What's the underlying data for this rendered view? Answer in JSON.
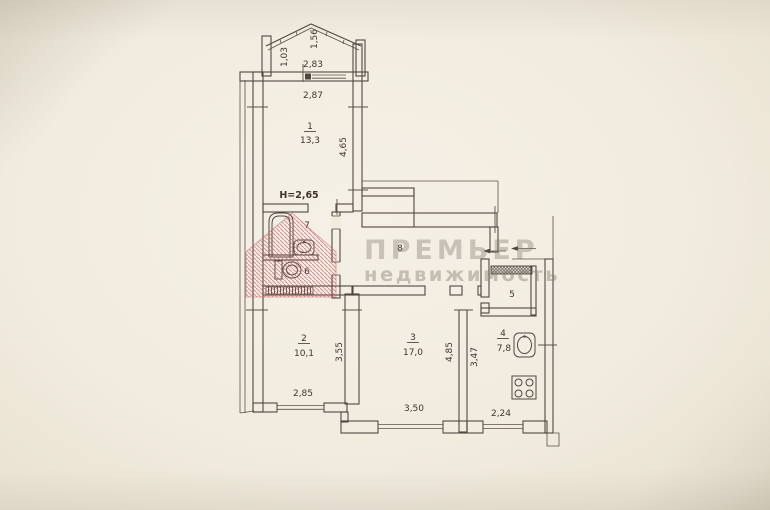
{
  "plan": {
    "height_note": "H=2,65",
    "rooms": [
      {
        "number": "1",
        "area": "13,3"
      },
      {
        "number": "2",
        "area": "10,1"
      },
      {
        "number": "3",
        "area": "17,0"
      },
      {
        "number": "4",
        "area": "7,8"
      },
      {
        "number": "5",
        "area": ""
      },
      {
        "number": "6",
        "area": ""
      },
      {
        "number": "7",
        "area": ""
      },
      {
        "number": "8",
        "area": ""
      }
    ],
    "dims": {
      "balcony_depth": "1,03",
      "balcony_side": "1,56",
      "balcony_width": "2,83",
      "room1_width": "2,87",
      "room1_length": "4,65",
      "room2_length": "3,55",
      "room2_width": "2,85",
      "room3_length": "4,85",
      "room3_width": "3,50",
      "kitchen_length": "3,47",
      "kitchen_width": "2,24"
    },
    "watermark": {
      "line1": "ПРЕМЬЕР",
      "line2": "недвижимость"
    },
    "colors": {
      "paper": "#f2ecdf",
      "line": "#4f4840",
      "logo_red": "#c2606a",
      "watermark_gray": "#80796c"
    }
  }
}
